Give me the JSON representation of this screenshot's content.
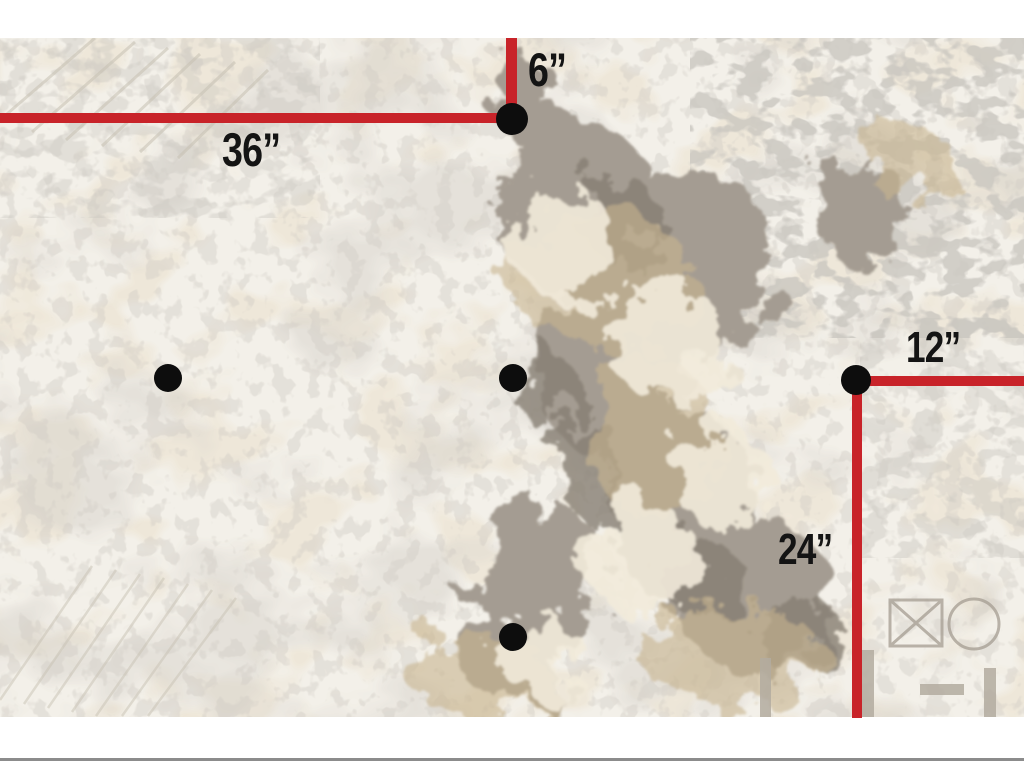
{
  "figure": {
    "description": "Aerial reconnaissance photo with measurement annotations",
    "photo_area": {
      "top": 38,
      "height": 679,
      "width": 1024
    }
  },
  "colors": {
    "page_bg": "#ffffff",
    "photo_base": "#f3f0e9",
    "line_red": "#c82329",
    "dot_black": "#0d0d0d",
    "label_black": "#141414",
    "bottom_rule_gray": "#8c8c8c"
  },
  "measurements": [
    {
      "id": "label-36",
      "label": "36”",
      "x": 222,
      "y": 126,
      "font_size": 47
    },
    {
      "id": "label-6",
      "label": "6”",
      "x": 528,
      "y": 46,
      "font_size": 47
    },
    {
      "id": "label-12",
      "label": "12”",
      "x": 906,
      "y": 326,
      "font_size": 44
    },
    {
      "id": "label-24",
      "label": "24”",
      "x": 778,
      "y": 528,
      "font_size": 44
    }
  ],
  "lines": [
    {
      "id": "line-36",
      "orientation": "horizontal",
      "x": 0,
      "y": 113,
      "length": 516,
      "thickness": 10
    },
    {
      "id": "line-6",
      "orientation": "vertical",
      "x": 506,
      "y": 38,
      "length": 85,
      "thickness": 11
    },
    {
      "id": "line-12",
      "orientation": "horizontal",
      "x": 856,
      "y": 376,
      "length": 168,
      "thickness": 10
    },
    {
      "id": "line-24",
      "orientation": "vertical",
      "x": 852,
      "y": 381,
      "length": 337,
      "thickness": 10
    }
  ],
  "markers": [
    {
      "id": "dot-1",
      "cx": 512,
      "cy": 119,
      "r": 16
    },
    {
      "id": "dot-2",
      "cx": 168,
      "cy": 378,
      "r": 14
    },
    {
      "id": "dot-3",
      "cx": 513,
      "cy": 378,
      "r": 14
    },
    {
      "id": "dot-4",
      "cx": 856,
      "cy": 380,
      "r": 15
    },
    {
      "id": "dot-5",
      "cx": 513,
      "cy": 637,
      "r": 14
    }
  ],
  "bottom_rule": {
    "y": 758,
    "height": 3
  }
}
